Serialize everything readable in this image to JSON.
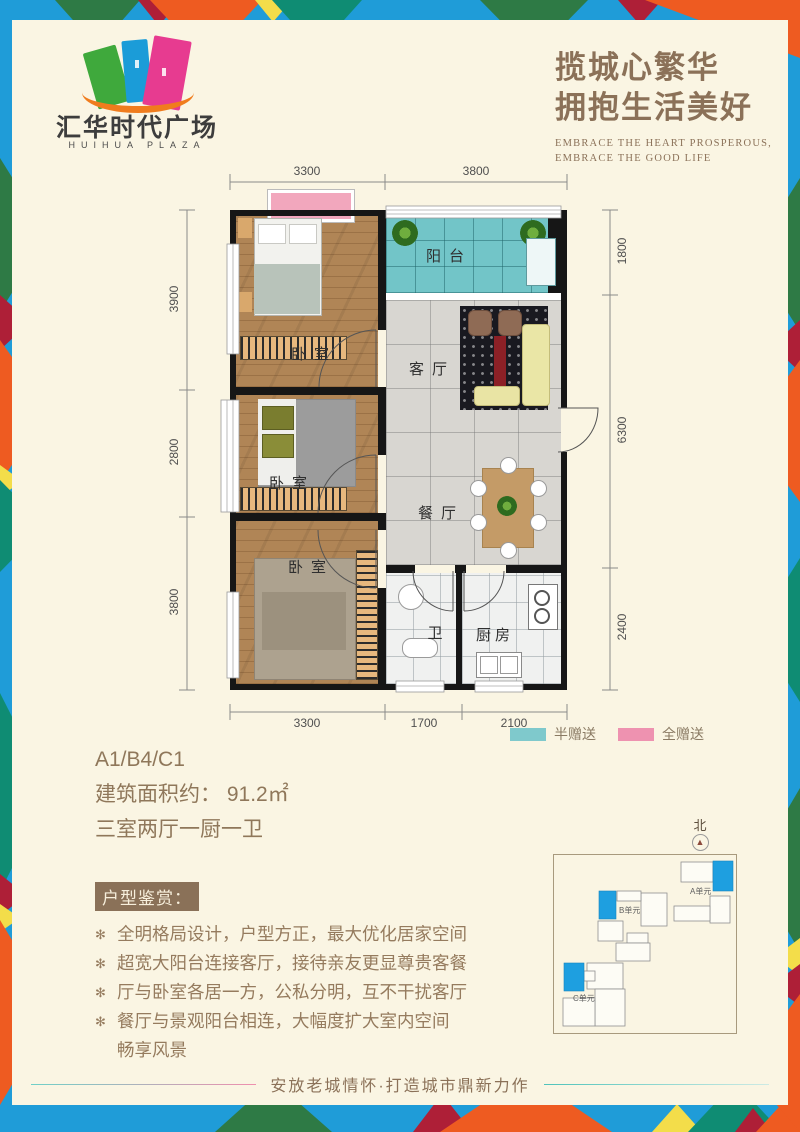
{
  "brand": {
    "title": "汇华时代广场",
    "subtitle": "HUIHUA PLAZA"
  },
  "slogan": {
    "line1": "揽城心繁华",
    "line2": "拥抱生活美好",
    "en1": "EMBRACE THE HEART PROSPEROUS,",
    "en2": "EMBRACE THE GOOD LIFE"
  },
  "floorplan": {
    "labels": {
      "balcony": "阳台",
      "living": "客厅",
      "dining": "餐厅",
      "bedroom": "卧室",
      "bath": "卫",
      "kitchen": "厨房"
    },
    "dims": {
      "top": [
        "3300",
        "3800"
      ],
      "bottom": [
        "3300",
        "1700",
        "2100"
      ],
      "left": [
        "3900",
        "2800",
        "3800"
      ],
      "right": [
        "1800",
        "6300",
        "2400"
      ]
    }
  },
  "legend": {
    "half_label": "半赠送",
    "half_color": "#7fc9cc",
    "full_label": "全赠送",
    "full_color": "#ee92b0"
  },
  "unit": {
    "code": "A1/B4/C1",
    "area": "建筑面积约： 91.2㎡",
    "rooms": "三室两厅一厨一卫"
  },
  "appreciation": {
    "title": "户型鉴赏：",
    "bullet_icon": "✻",
    "bullets": [
      "全明格局设计，户型方正，最大优化居家空间",
      "超宽大阳台连接客厅，接待亲友更显尊贵客餐",
      "厅与卧室各居一方，公私分明，互不干扰客厅",
      "餐厅与景观阳台相连，大幅度扩大室内空间\n畅享风景"
    ]
  },
  "sitemap": {
    "north_label": "北",
    "north_arrow": "▲",
    "units": [
      "A单元",
      "B单元",
      "C单元"
    ],
    "highlight_color": "#1e9fe0"
  },
  "footer": {
    "text": "安放老城情怀·打造城市鼎新力作"
  },
  "colors": {
    "panel_bg": "#faf5e3",
    "brand_brown": "#8b7158",
    "border_palette": [
      "#1f9cd8",
      "#2e7a45",
      "#ae1f37",
      "#ee5b21",
      "#f3dd4a",
      "#0f8c73"
    ]
  }
}
